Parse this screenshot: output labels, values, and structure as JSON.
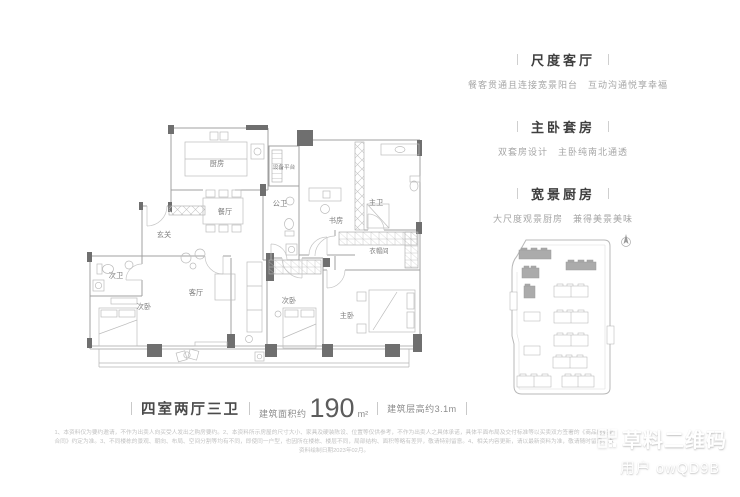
{
  "floorplan": {
    "rooms": {
      "kitchen": "厨房",
      "equipment_platform": "设备平台",
      "guest_bath": "公卫",
      "study": "书房",
      "master_bath": "主卫",
      "dining": "餐厅",
      "foyer": "玄关",
      "second_bath": "次卫",
      "bedroom_west": "次卧",
      "living": "客厅",
      "bedroom_middle": "次卧",
      "cloakroom": "衣帽间",
      "master_bedroom": "主卧"
    }
  },
  "features": {
    "sections": [
      {
        "title": "尺度客厅",
        "desc": "餐客贯通且连接宽景阳台　互动沟通悦享幸福"
      },
      {
        "title": "主卧套房",
        "desc": "双套房设计　主卧纯南北通透"
      },
      {
        "title": "宽景厨房",
        "desc": "大尺度观景厨房　兼得美景美味"
      }
    ]
  },
  "summary": {
    "layout_type": "四室两厅三卫",
    "area_prefix": "建筑面积约",
    "area_value": "190",
    "area_unit": "m²",
    "floor_height": "建筑层高约3.1m"
  },
  "disclaimer": "1、本资料仅为要约邀请，不作为出卖人向买受人发出之购房要约。2、本资料所示房屋的尺寸大小、家具及硬装陈设、位置等仅供参考，不作为出卖人之具体承诺，具体平面布局及交付标准等以买卖双方签署的《商品房买卖合同》约定为准。3、不同楼栋的景观、朝向、布局、空间分割等均有不同，即使同一户型，也因所在楼栋、楼层不同，局部结构、面积等略有差异，敬请特别留意。4、相关内容更新，请以最新资料为准，敬请随时留意。本资料绘制日期2023年02月。",
  "watermark": {
    "brand": "草料二维码",
    "user": "用户 owQD9B"
  },
  "colors": {
    "wall_dark": "#6f6f6f",
    "wall_line": "#a0a0a0",
    "furniture_line": "#bcbcbc",
    "room_text": "#7d7d7d",
    "highlight_building": "#ababab"
  }
}
